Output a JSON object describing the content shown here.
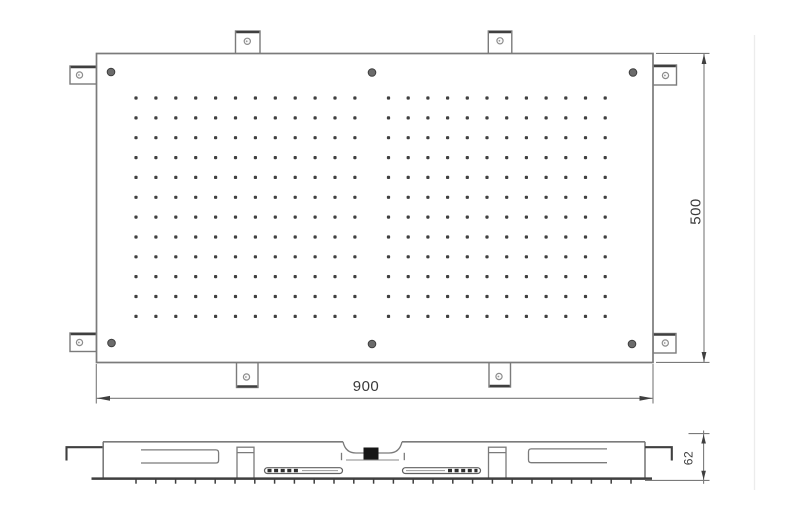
{
  "labels": {
    "width": "900",
    "height": "500",
    "depth": "62"
  },
  "colors": {
    "outline": "#7b7b7b",
    "dark_edge": "#3f3f3f",
    "dot": "#242424",
    "dim_line": "#7a7a7a",
    "text": "#3a3a3a",
    "screw_fill": "#6b6b6b",
    "screw_rim": "#3d3d3d",
    "hole_ring": "#8d8d8d",
    "inlet": "#161616"
  },
  "top_view": {
    "panel": {
      "x": 96.5,
      "y": 53.5,
      "w": 556.5,
      "h": 309
    },
    "nozzle_grid": {
      "rows": 12,
      "row_start": 98,
      "row_spacing": 19.85,
      "dot_size": 3.2,
      "blocks": [
        {
          "cols": 12,
          "x_start": 136,
          "spacing": 19.9
        },
        {
          "cols": 12,
          "x_start": 388.5,
          "spacing": 19.7
        }
      ]
    },
    "screws": [
      [
        111,
        72
      ],
      [
        372,
        72.5
      ],
      [
        633,
        72.5
      ],
      [
        111.5,
        343
      ],
      [
        372,
        344
      ],
      [
        632,
        344
      ]
    ],
    "screw_radius": 3.8,
    "tabs": [
      {
        "x": 235.5,
        "y": 31,
        "w": 24.5,
        "h": 23.5,
        "edge": "top",
        "hole": [
          247.3,
          41.3
        ]
      },
      {
        "x": 488.3,
        "y": 31,
        "w": 23.5,
        "h": 23.5,
        "edge": "top",
        "hole": [
          500,
          40.8
        ]
      },
      {
        "x": 236.5,
        "y": 362.5,
        "w": 21.5,
        "h": 25,
        "edge": "bottom",
        "hole": [
          246.5,
          377
        ]
      },
      {
        "x": 489,
        "y": 362.5,
        "w": 21.5,
        "h": 24.5,
        "edge": "bottom",
        "hole": [
          499,
          376.5
        ]
      },
      {
        "x": 70,
        "y": 66,
        "w": 26.5,
        "h": 18,
        "edge": "left",
        "hole": [
          79.5,
          75
        ]
      },
      {
        "x": 70,
        "y": 333,
        "w": 26.5,
        "h": 18.5,
        "edge": "left",
        "hole": [
          79.5,
          342.5
        ]
      },
      {
        "x": 653,
        "y": 65,
        "w": 23.5,
        "h": 20,
        "edge": "right",
        "hole": [
          665.5,
          75.5
        ]
      },
      {
        "x": 653,
        "y": 333.5,
        "w": 23,
        "h": 19.5,
        "edge": "right",
        "hole": [
          665.3,
          343
        ]
      }
    ],
    "hole_radius": 3.1
  },
  "side_view": {
    "nozzle_ticks": {
      "x_start": 136,
      "spacing": 19.8,
      "count": 26,
      "y": 479.2,
      "len": 4.5
    }
  }
}
